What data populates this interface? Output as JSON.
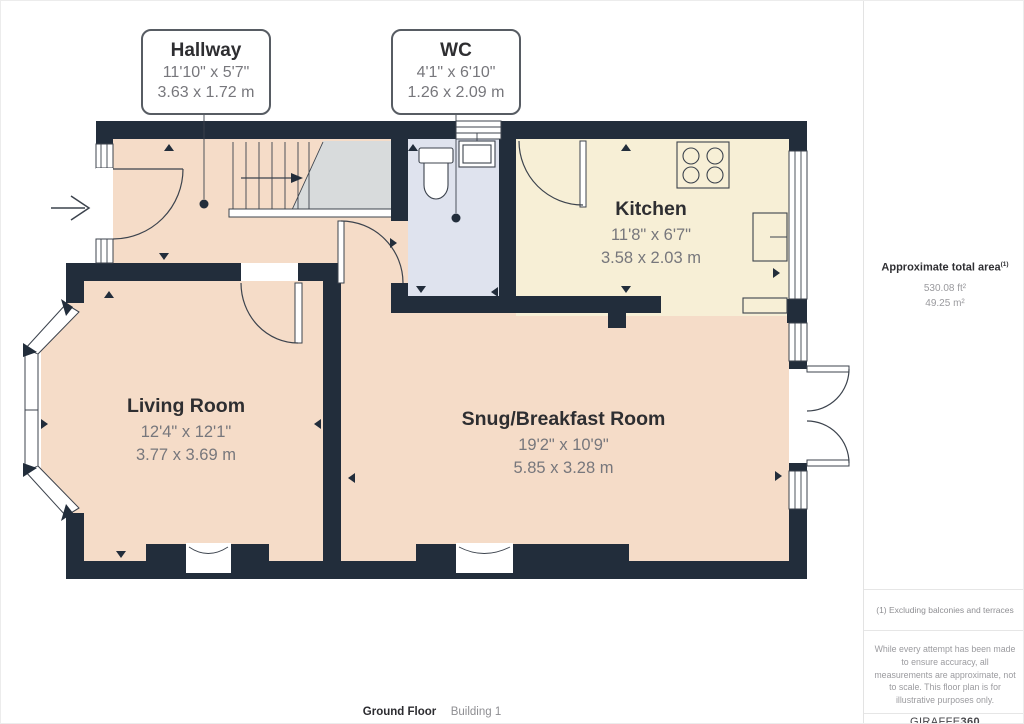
{
  "colors": {
    "wall": "#222d3b",
    "floor-peach": "#f5dcc8",
    "floor-cream": "#f7efd6",
    "floor-wc": "#dfe3ee",
    "floor-landing": "#d8dbdc",
    "line": "#3c434d",
    "accent-text": "#2e2e31",
    "dim-text": "#77777c"
  },
  "callouts": {
    "hallway": {
      "name": "Hallway",
      "imperial": "11'10\" x 5'7\"",
      "metric": "3.63 x 1.72 m"
    },
    "wc": {
      "name": "WC",
      "imperial": "4'1\" x 6'10\"",
      "metric": "1.26 x 2.09 m"
    }
  },
  "rooms": {
    "kitchen": {
      "name": "Kitchen",
      "imperial": "11'8\" x 6'7\"",
      "metric": "3.58 x 2.03 m"
    },
    "living": {
      "name": "Living Room",
      "imperial": "12'4\" x 12'1\"",
      "metric": "3.77 x 3.69 m"
    },
    "snug": {
      "name": "Snug/Breakfast Room",
      "imperial": "19'2\" x 10'9\"",
      "metric": "5.85 x 3.28 m"
    }
  },
  "sidebar": {
    "total_area_label": "Approximate total area",
    "total_area_sup": "(1)",
    "area_ft": "530.08 ft²",
    "area_m": "49.25 m²",
    "footnote": "(1) Excluding balconies and terraces",
    "disclaimer": "While every attempt has been made to ensure accuracy, all measurements are approximate, not to scale. This floor plan is for illustrative purposes only.",
    "brand_name": "GIRAFFE",
    "brand_suffix": "360"
  },
  "footer": {
    "floor_label": "Ground Floor",
    "building_label": "Building 1"
  }
}
